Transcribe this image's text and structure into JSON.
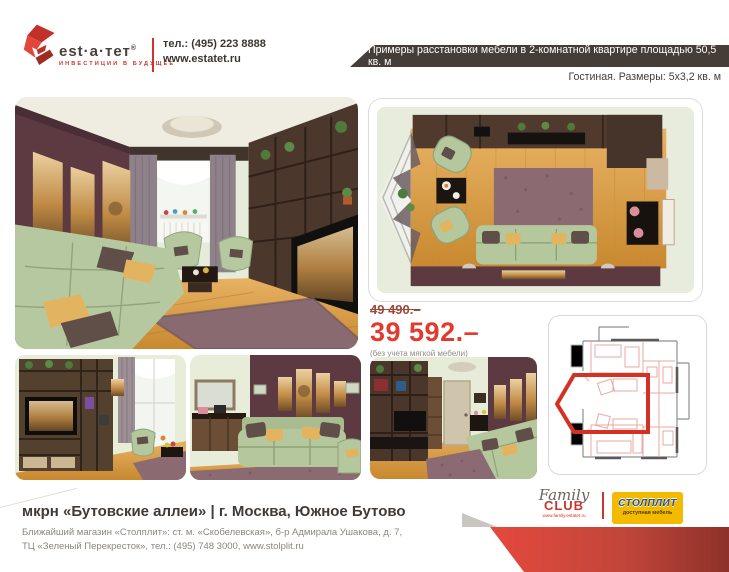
{
  "header": {
    "brand": "est·a·тет",
    "brand_mark": "®",
    "tagline": "инвестиции в будущее",
    "phone": "тел.: (495) 223 8888",
    "website": "www.estatet.ru"
  },
  "banner": {
    "text": "Примеры расстановки мебели в 2-комнатной квартире площадью 50,5 кв. м",
    "bg_color": "#453e38",
    "text_color": "#ffffff"
  },
  "subtitle": "Гостиная. Размеры: 5х3,2 кв. м",
  "pricing": {
    "old_price": "49 490.–",
    "new_price": "39 592.–",
    "note": "(без учета мягкой мебели)",
    "old_price_color": "#9c4a3c",
    "new_price_color": "#e23a2d"
  },
  "images": {
    "main": "living-room-perspective-render",
    "top_view": "living-room-top-down-render",
    "small_1": "tv-wall-unit-render",
    "small_2": "sofa-wall-art-render",
    "small_3": "room-entrance-render",
    "plan": "apartment-floor-plan-living-room-highlighted"
  },
  "footer": {
    "title": "мкрн «Бутовские аллеи» | г. Москва, Южное Бутово",
    "address_line1": "Ближайший магазин «Столплит»: ст. м. «Скобелевская», б-р Адмирала Ушакова, д. 7,",
    "address_line2": "ТЦ «Зеленый Перекресток», тел.: (495) 748 3000, www.stolplit.ru",
    "family_club": {
      "script": "Family",
      "caps": "CLUB",
      "url": "www.family.estatet.ru"
    },
    "stolplit": {
      "name": "СТОЛПЛИТ",
      "tagline": "доступная мебель",
      "bg_color": "#f3ba00",
      "name_color": "#1d4f9c"
    }
  },
  "colors": {
    "accent_red": "#cf3428",
    "ribbon_left": "#e5493d",
    "ribbon_right": "#8e3129"
  }
}
